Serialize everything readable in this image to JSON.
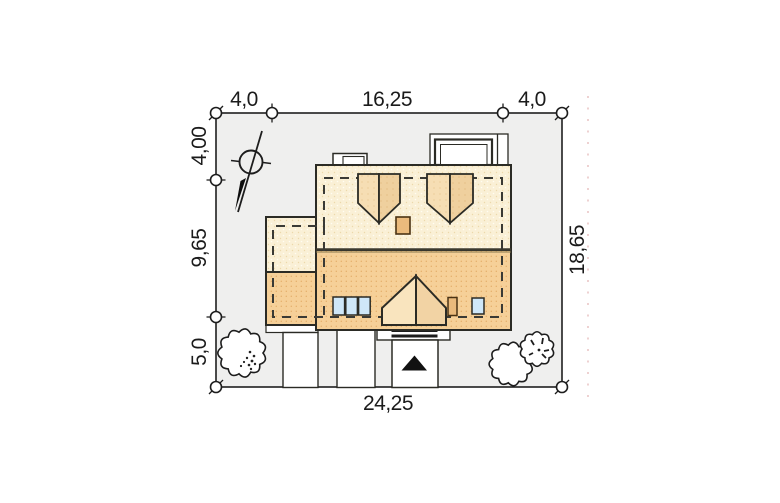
{
  "plan": {
    "type": "house site plan (roof view)",
    "dimensions": {
      "top_left": "4,0",
      "top_middle": "16,25",
      "top_right": "4,0",
      "left_top": "4,00",
      "left_middle": "9,65",
      "left_bottom": "5,0",
      "right_side": "18,65",
      "bottom": "24,25"
    }
  },
  "colors": {
    "lot_fill": "#efefee",
    "line": "#2b2b25",
    "roof_back": "#faf0d6",
    "roof_back_dot": "#ecd9ab",
    "roof_front": "#f6d098",
    "roof_front_dot": "#e3ab66",
    "dormer_light": "#f6deb4",
    "dormer_dark": "#efd09e",
    "porch_light": "#f9e4be",
    "porch_dark": "#f2d3a4",
    "chimney": "#eaba7c",
    "window": "#cfe7f8",
    "arrow": "#111111",
    "crop_dots": "#d99a9a"
  }
}
